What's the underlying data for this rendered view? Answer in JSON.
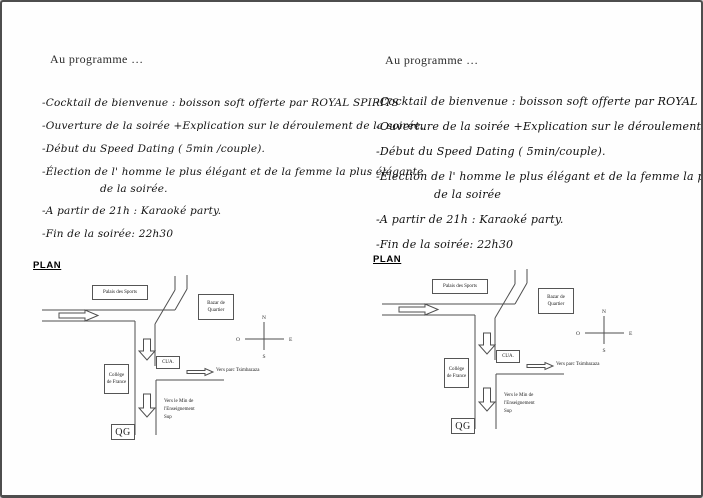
{
  "colors": {
    "ink": "#1c1c1c",
    "map_line": "#4f4f4f",
    "page_border": "#4e4e4e"
  },
  "flyer_left": {
    "heading": "Au programme …",
    "program": [
      "-Cocktail de bienvenue : boisson soft offerte par ROYAL SPIRITS",
      "-Ouverture de la soirée +Explication sur le déroulement de la soirée.",
      "-Début du Speed Dating ( 5min /couple).",
      "-Élection de l' homme le plus élégant et de la femme la plus élégante",
      "de la  soirée.",
      "-A partir de 21h : Karaoké party.",
      "-Fin de la soirée: 22h30"
    ],
    "plan_title": "PLAN",
    "map": {
      "palais_des_sports": "Palais des Sports",
      "bazar_de_quartier": "Bazar de Quartier",
      "cua": "CUA.",
      "college_de_france": "Collège de France",
      "qg": "QG",
      "vers_parc": "Vers parc Tsimbazaza",
      "vers_ministere": "Vers le Min de l'Enseignement Sup",
      "compass": {
        "north": "N",
        "south": "S",
        "east": "E",
        "west": "O"
      }
    }
  },
  "flyer_right": {
    "heading": "Au programme …",
    "program": [
      "-Cocktail de bienvenue : boisson soft offerte par ROYAL SPIRITS",
      "-Ouverture de la soirée +Explication sur le déroulement de la soirée.",
      "-Début du Speed Dating ( 5min/couple).",
      "-Élection de l' homme le plus élégant et de la femme la plus élégante",
      "de la  soirée",
      "-A partir de 21h : Karaoké party.",
      "-Fin de la soirée: 22h30"
    ],
    "plan_title": "PLAN",
    "map": {
      "palais_des_sports": "Palais des Sports",
      "bazar_de_quartier": "Bazar de Quartier",
      "cua": "CUA.",
      "college_de_france": "Collège de France",
      "qg": "QG",
      "vers_parc": "Vers parc Tsimbazaza",
      "vers_ministere": "Vers le Min de l'Enseignement Sup",
      "compass": {
        "north": "N",
        "south": "S",
        "east": "E",
        "west": "O"
      }
    }
  }
}
